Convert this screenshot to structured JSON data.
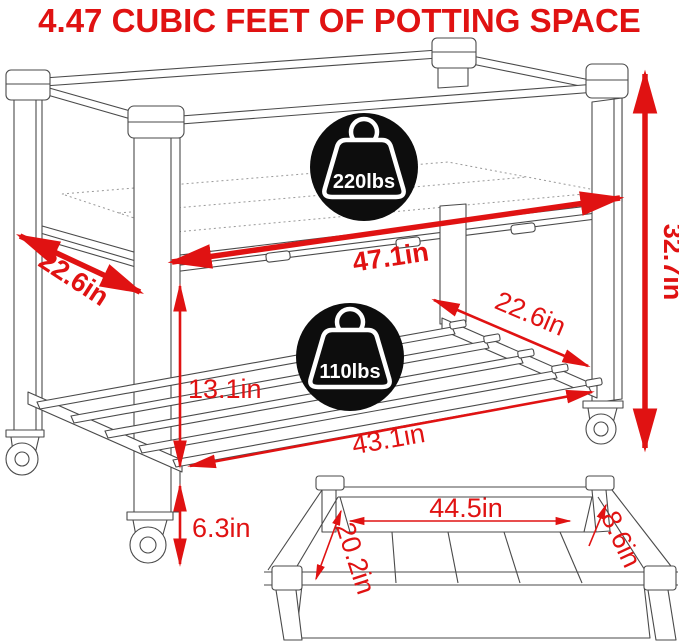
{
  "title": "4.47 CUBIC FEET OF POTTING SPACE",
  "colors": {
    "accent_red": "#e01212",
    "line_gray": "#4a4a4a",
    "badge_black": "#0d0d0d",
    "badge_text": "#ffffff",
    "background": "#ffffff"
  },
  "badges": {
    "bed_capacity": {
      "label": "220lbs",
      "icon": "weight-icon"
    },
    "shelf_capacity": {
      "label": "110lbs",
      "icon": "weight-icon"
    }
  },
  "dimensions": {
    "bed_depth": "22.6in",
    "bed_width": "47.1in",
    "overall_height": "32.7in",
    "shelf_depth": "22.6in",
    "bed_to_shelf": "13.1in",
    "shelf_width": "43.1in",
    "ground_clearance": "6.3in",
    "inset_inner_length": "44.5in",
    "inset_inner_width": "20.2in",
    "inset_inner_depth": "8.6in"
  }
}
